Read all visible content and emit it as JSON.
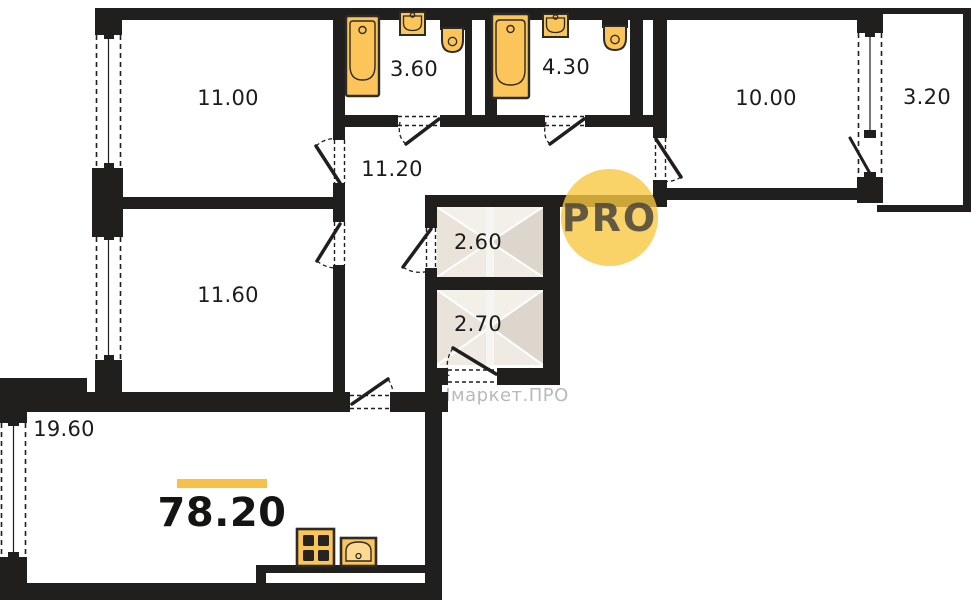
{
  "plan": {
    "total_area": "78.20",
    "rooms": {
      "room1": "11.00",
      "bath1": "3.60",
      "bath2": "4.30",
      "room2": "10.00",
      "balcony": "3.20",
      "hallway": "11.20",
      "closet1": "2.60",
      "closet2": "2.70",
      "room3": "11.60",
      "kitchen": "19.60"
    },
    "branding": {
      "logo": "PRO",
      "watermark": "Нмаркет.ПРО"
    },
    "colors": {
      "wall": "#201f1d",
      "fixture_fill": "#fbc55a",
      "fixture_stroke": "#2e2b26",
      "accent_bar": "#f6c04a",
      "logo_circle": "#f7c742",
      "watermark_text": "#b9b9b7",
      "wardrobe_fill": "#e9e3da"
    }
  }
}
